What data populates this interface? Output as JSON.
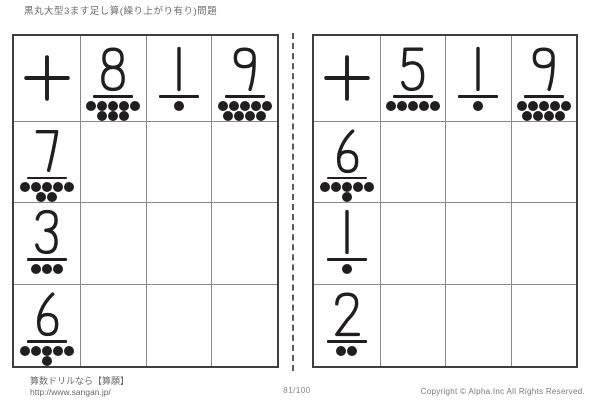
{
  "page": {
    "title": "黒丸大型3ます足し算(繰り上がり有り)問題",
    "page_number": "81/100"
  },
  "footer": {
    "site_name": "算数ドリルなら【算願】",
    "site_url": "http://www.sangan.jp/",
    "copyright": "Copyright © Alpha.Inc All Rights Reserved."
  },
  "colors": {
    "ink": "#221e1f",
    "grid_outer_border": "#3f3f3f",
    "grid_inner_lines": "#8a8a8a"
  },
  "dots_max_per_row": 5,
  "tables": [
    {
      "name": "left-grid",
      "operator": "+",
      "column_headers": [
        8,
        1,
        9
      ],
      "row_headers": [
        7,
        3,
        6
      ]
    },
    {
      "name": "right-grid",
      "operator": "+",
      "column_headers": [
        5,
        1,
        9
      ],
      "row_headers": [
        6,
        1,
        2
      ]
    }
  ]
}
